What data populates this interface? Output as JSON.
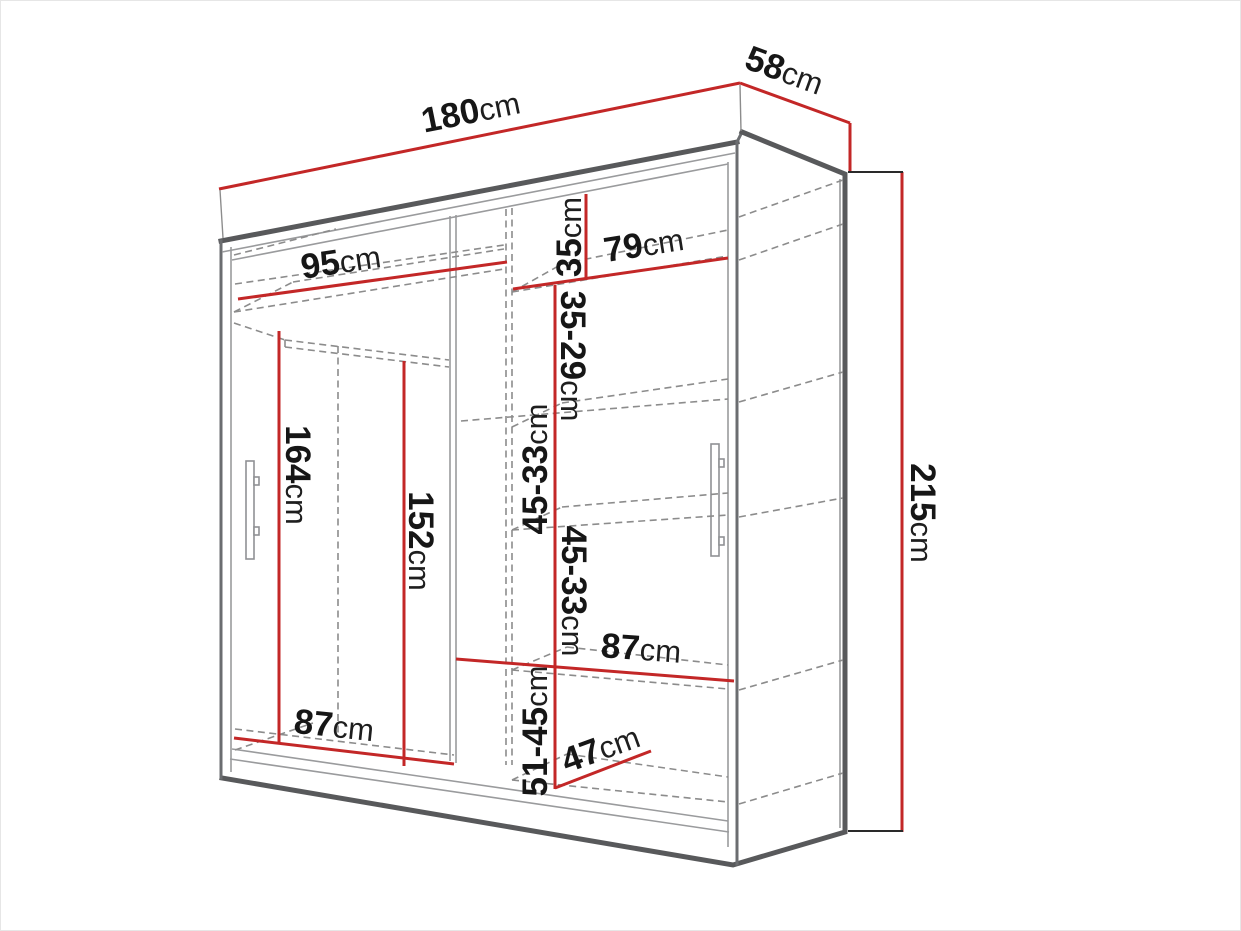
{
  "diagram_kind": "wardrobe-dimension-drawing",
  "unit": "cm",
  "colors": {
    "dimension_line": "#c32727",
    "cabinet_outline": "#58595b",
    "hidden_edge_dashed": "#8c8c8c",
    "label_text": "#161616",
    "background": "#ffffff"
  },
  "dims": {
    "w180": {
      "num": "180",
      "unit": "cm"
    },
    "d58": {
      "num": "58",
      "unit": "cm"
    },
    "h215": {
      "num": "215",
      "unit": "cm"
    },
    "w95": {
      "num": "95",
      "unit": "cm"
    },
    "w79": {
      "num": "79",
      "unit": "cm"
    },
    "g35": {
      "num": "35",
      "unit": "cm"
    },
    "g3529": {
      "num": "35-29",
      "unit": "cm"
    },
    "g4533a": {
      "num": "45-33",
      "unit": "cm"
    },
    "g4533b": {
      "num": "45-33",
      "unit": "cm"
    },
    "w87r": {
      "num": "87",
      "unit": "cm"
    },
    "g5145": {
      "num": "51-45",
      "unit": "cm"
    },
    "d47": {
      "num": "47",
      "unit": "cm"
    },
    "h164": {
      "num": "164",
      "unit": "cm"
    },
    "h152": {
      "num": "152",
      "unit": "cm"
    },
    "w87l": {
      "num": "87",
      "unit": "cm"
    }
  }
}
